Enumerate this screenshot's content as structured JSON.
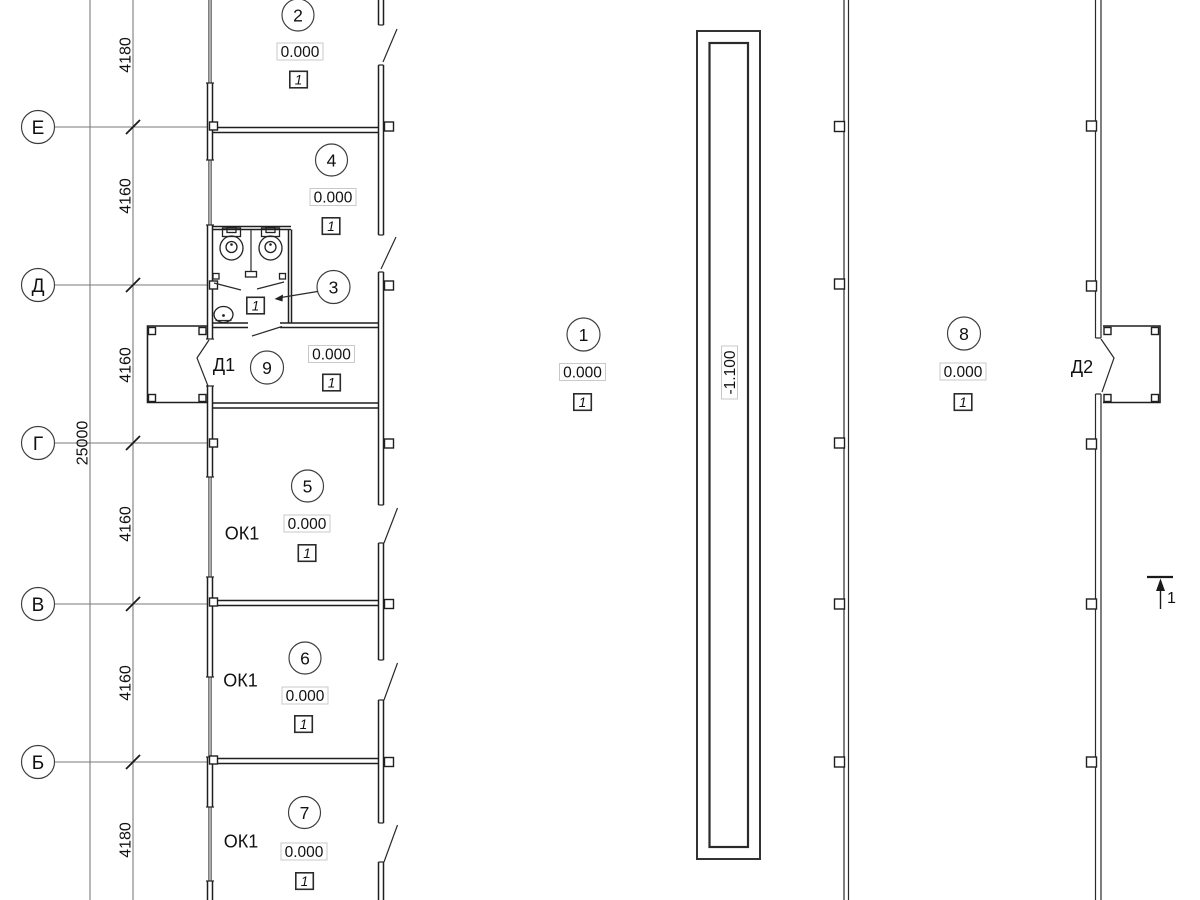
{
  "title": "floor-plan",
  "colors": {
    "wall": "#1f1f1f",
    "axis_line": "#7a7a7a",
    "elev_box_border": "#c9c9c9"
  },
  "axes": {
    "labels": [
      "Е",
      "Д",
      "Г",
      "В",
      "Б"
    ]
  },
  "dimensions": {
    "intervals": [
      "4180",
      "4160",
      "4160",
      "4160",
      "4160",
      "4180"
    ],
    "total": "25000"
  },
  "rooms": [
    {
      "number": "2",
      "elevation": "0.000",
      "mark": "1"
    },
    {
      "number": "4",
      "elevation": "0.000",
      "mark": "1"
    },
    {
      "number": "3",
      "mark": "1"
    },
    {
      "number": "9",
      "elevation": "0.000",
      "mark": "1",
      "door_label": "Д1"
    },
    {
      "number": "5",
      "elevation": "0.000",
      "mark": "1",
      "window_label": "ОК1"
    },
    {
      "number": "6",
      "elevation": "0.000",
      "mark": "1",
      "window_label": "ОК1"
    },
    {
      "number": "7",
      "elevation": "0.000",
      "mark": "1",
      "window_label": "ОК1"
    },
    {
      "number": "1",
      "elevation": "0.000",
      "mark": "1"
    },
    {
      "number": "8",
      "elevation": "0.000",
      "mark": "1",
      "door_label": "Д2"
    }
  ],
  "trench": {
    "elevation": "-1.100"
  },
  "section": {
    "label": "1"
  }
}
